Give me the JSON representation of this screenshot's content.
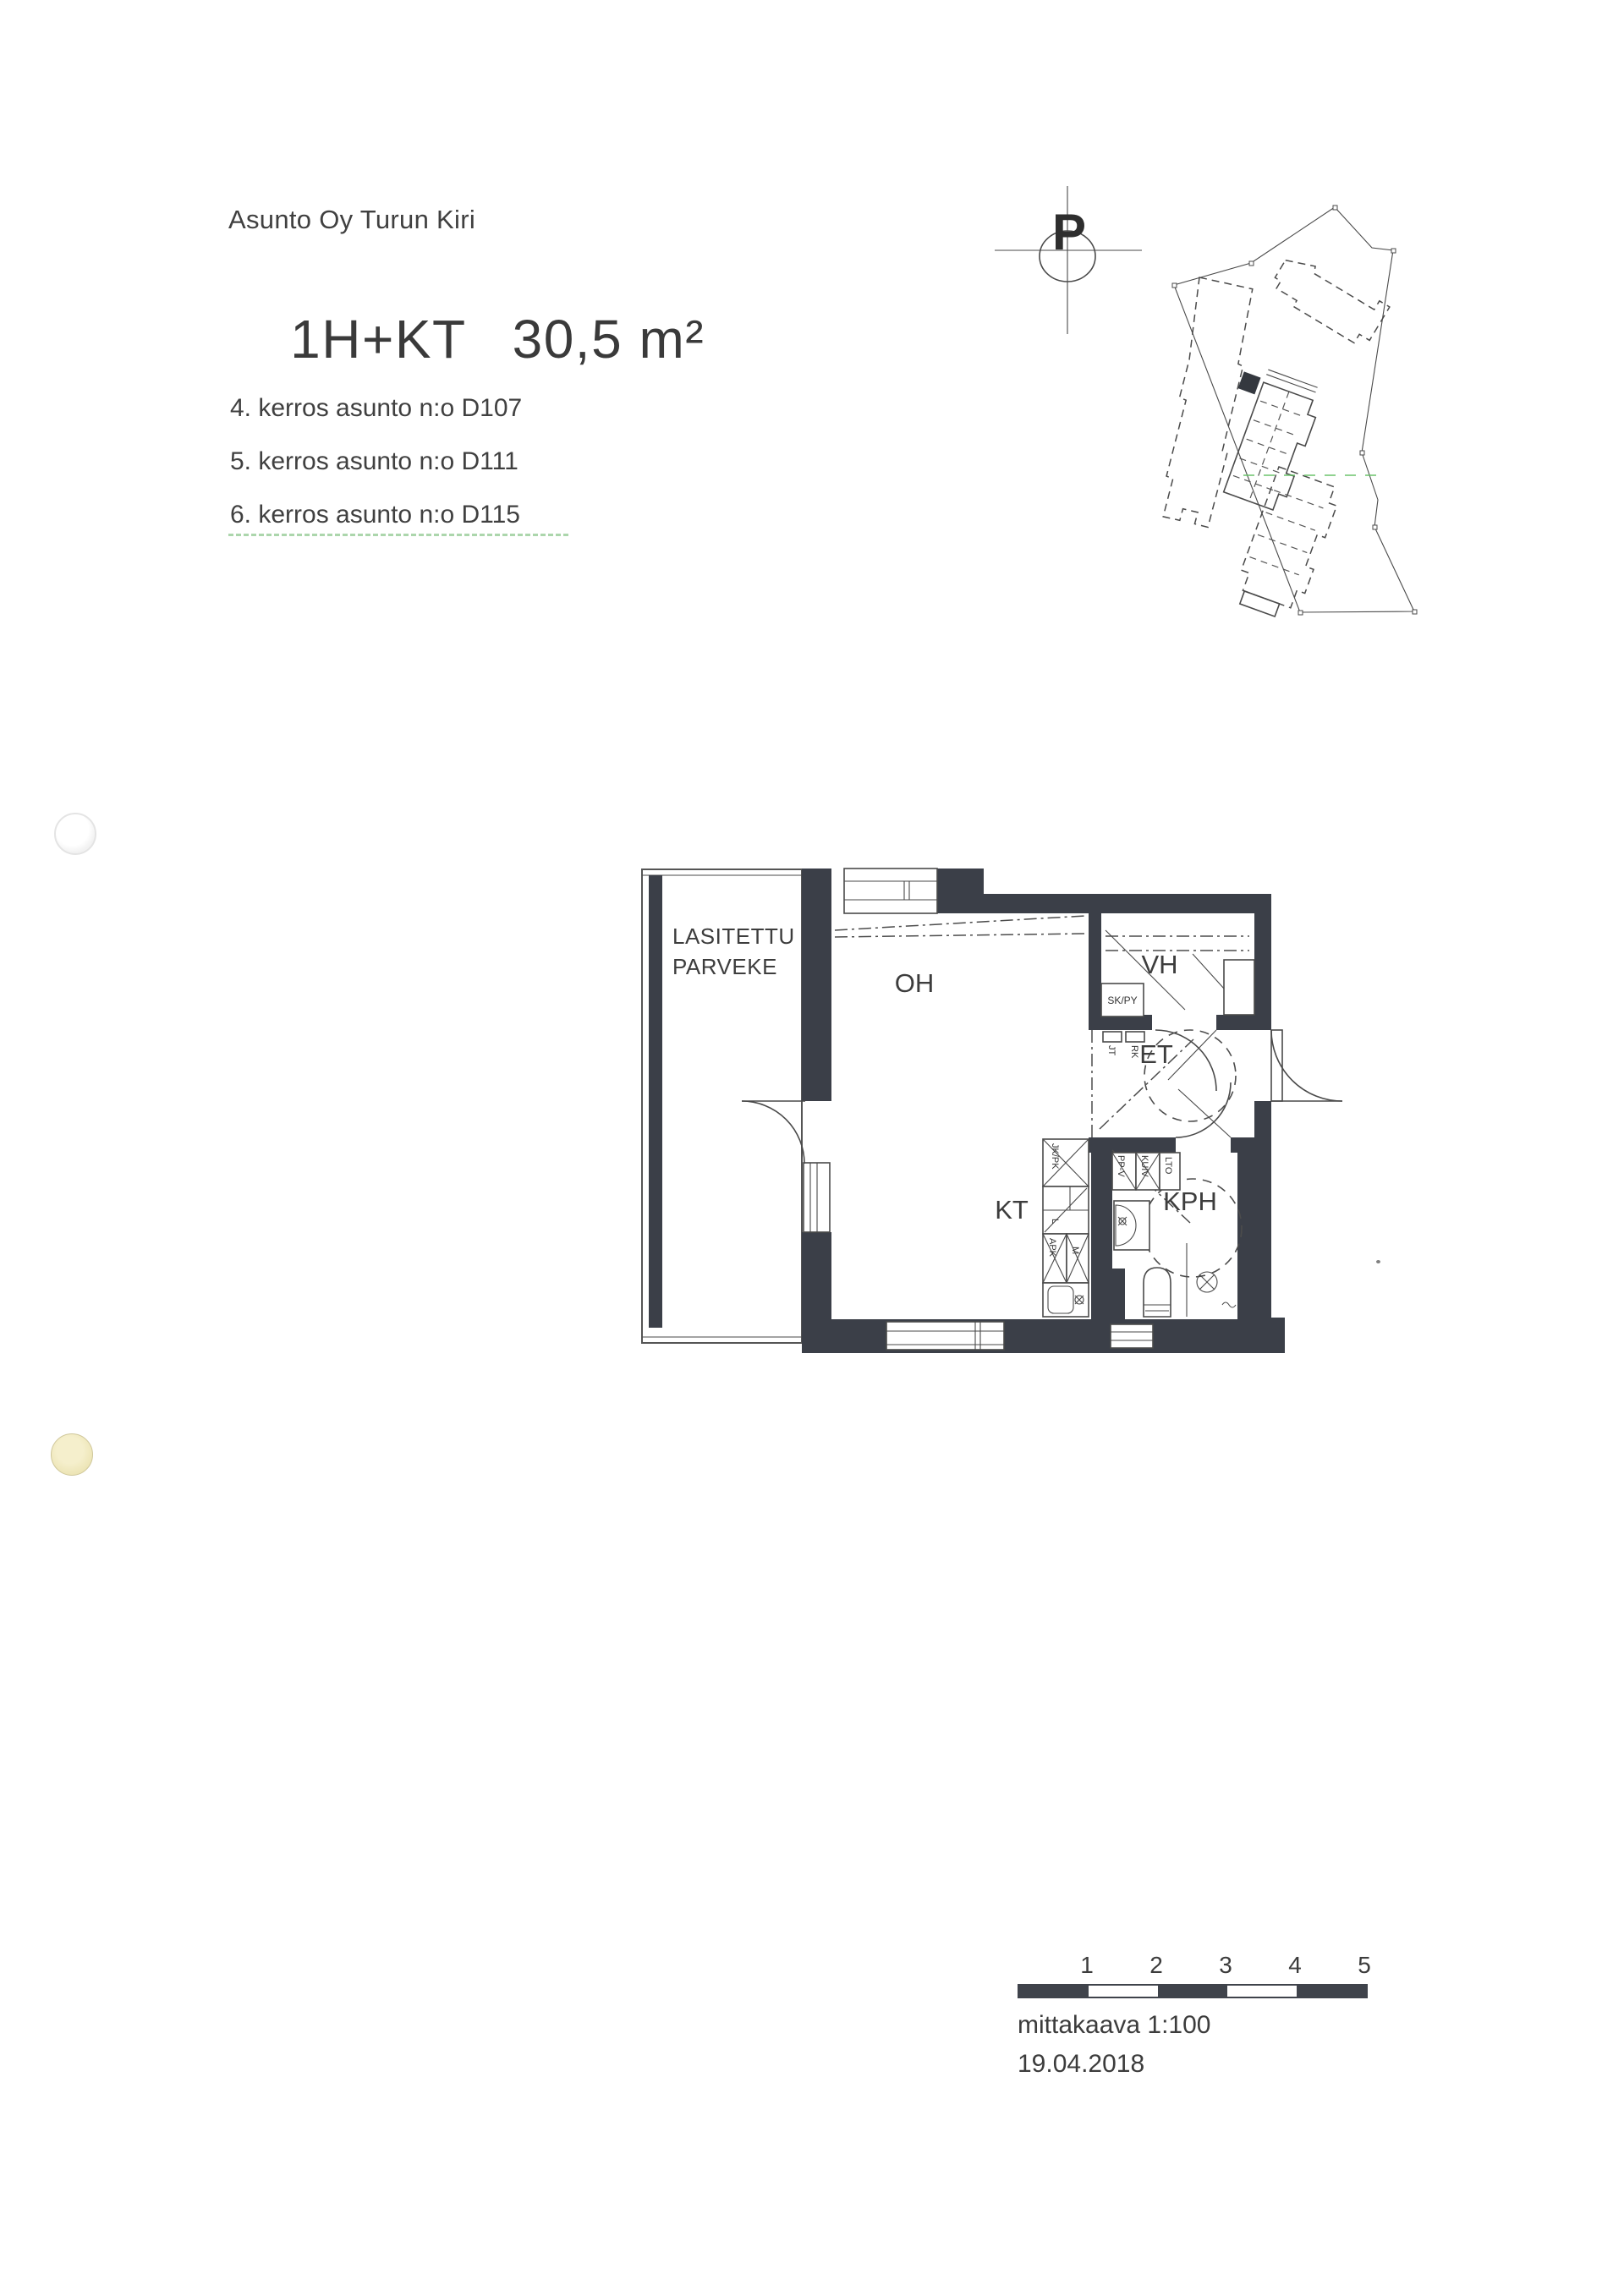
{
  "header": {
    "company": "Asunto Oy Turun Kiri",
    "apartment_type": "1H+KT",
    "area": "30,5 m²",
    "floors": [
      {
        "label": "4. kerros asunto n:o D107"
      },
      {
        "label": "5. kerros asunto n:o D111"
      },
      {
        "label": "6. kerros asunto n:o D115"
      }
    ]
  },
  "site_plan": {
    "north_label": "P"
  },
  "floor_plan": {
    "rooms": {
      "balcony_line1": "LASITETTU",
      "balcony_line2": "PARVEKE",
      "living_room": "OH",
      "walk_in_closet": "VH",
      "entry_hall": "ET",
      "kitchenette": "KT",
      "bathroom": "KPH"
    },
    "labels": {
      "closet_cabinet": "SK/PY",
      "jt": "JT",
      "rk": "RK",
      "fridge_freezer": "JK/PK",
      "stove": "L",
      "dishwasher": "APK",
      "microwave": "M",
      "washer_reservation": "PP-V",
      "dryer_reservation": "KUIV",
      "heat_recovery": "LTO"
    }
  },
  "footer": {
    "scale_ticks": [
      "1",
      "2",
      "3",
      "4",
      "5"
    ],
    "scale_label": "mittakaava 1:100",
    "date": "19.04.2018"
  },
  "colors": {
    "ink": "#3b3f48",
    "line": "#4a4a4a",
    "text": "#3f3f3f",
    "scan_green": "#5cb85c",
    "punch_yellow": "#efe9c4"
  }
}
